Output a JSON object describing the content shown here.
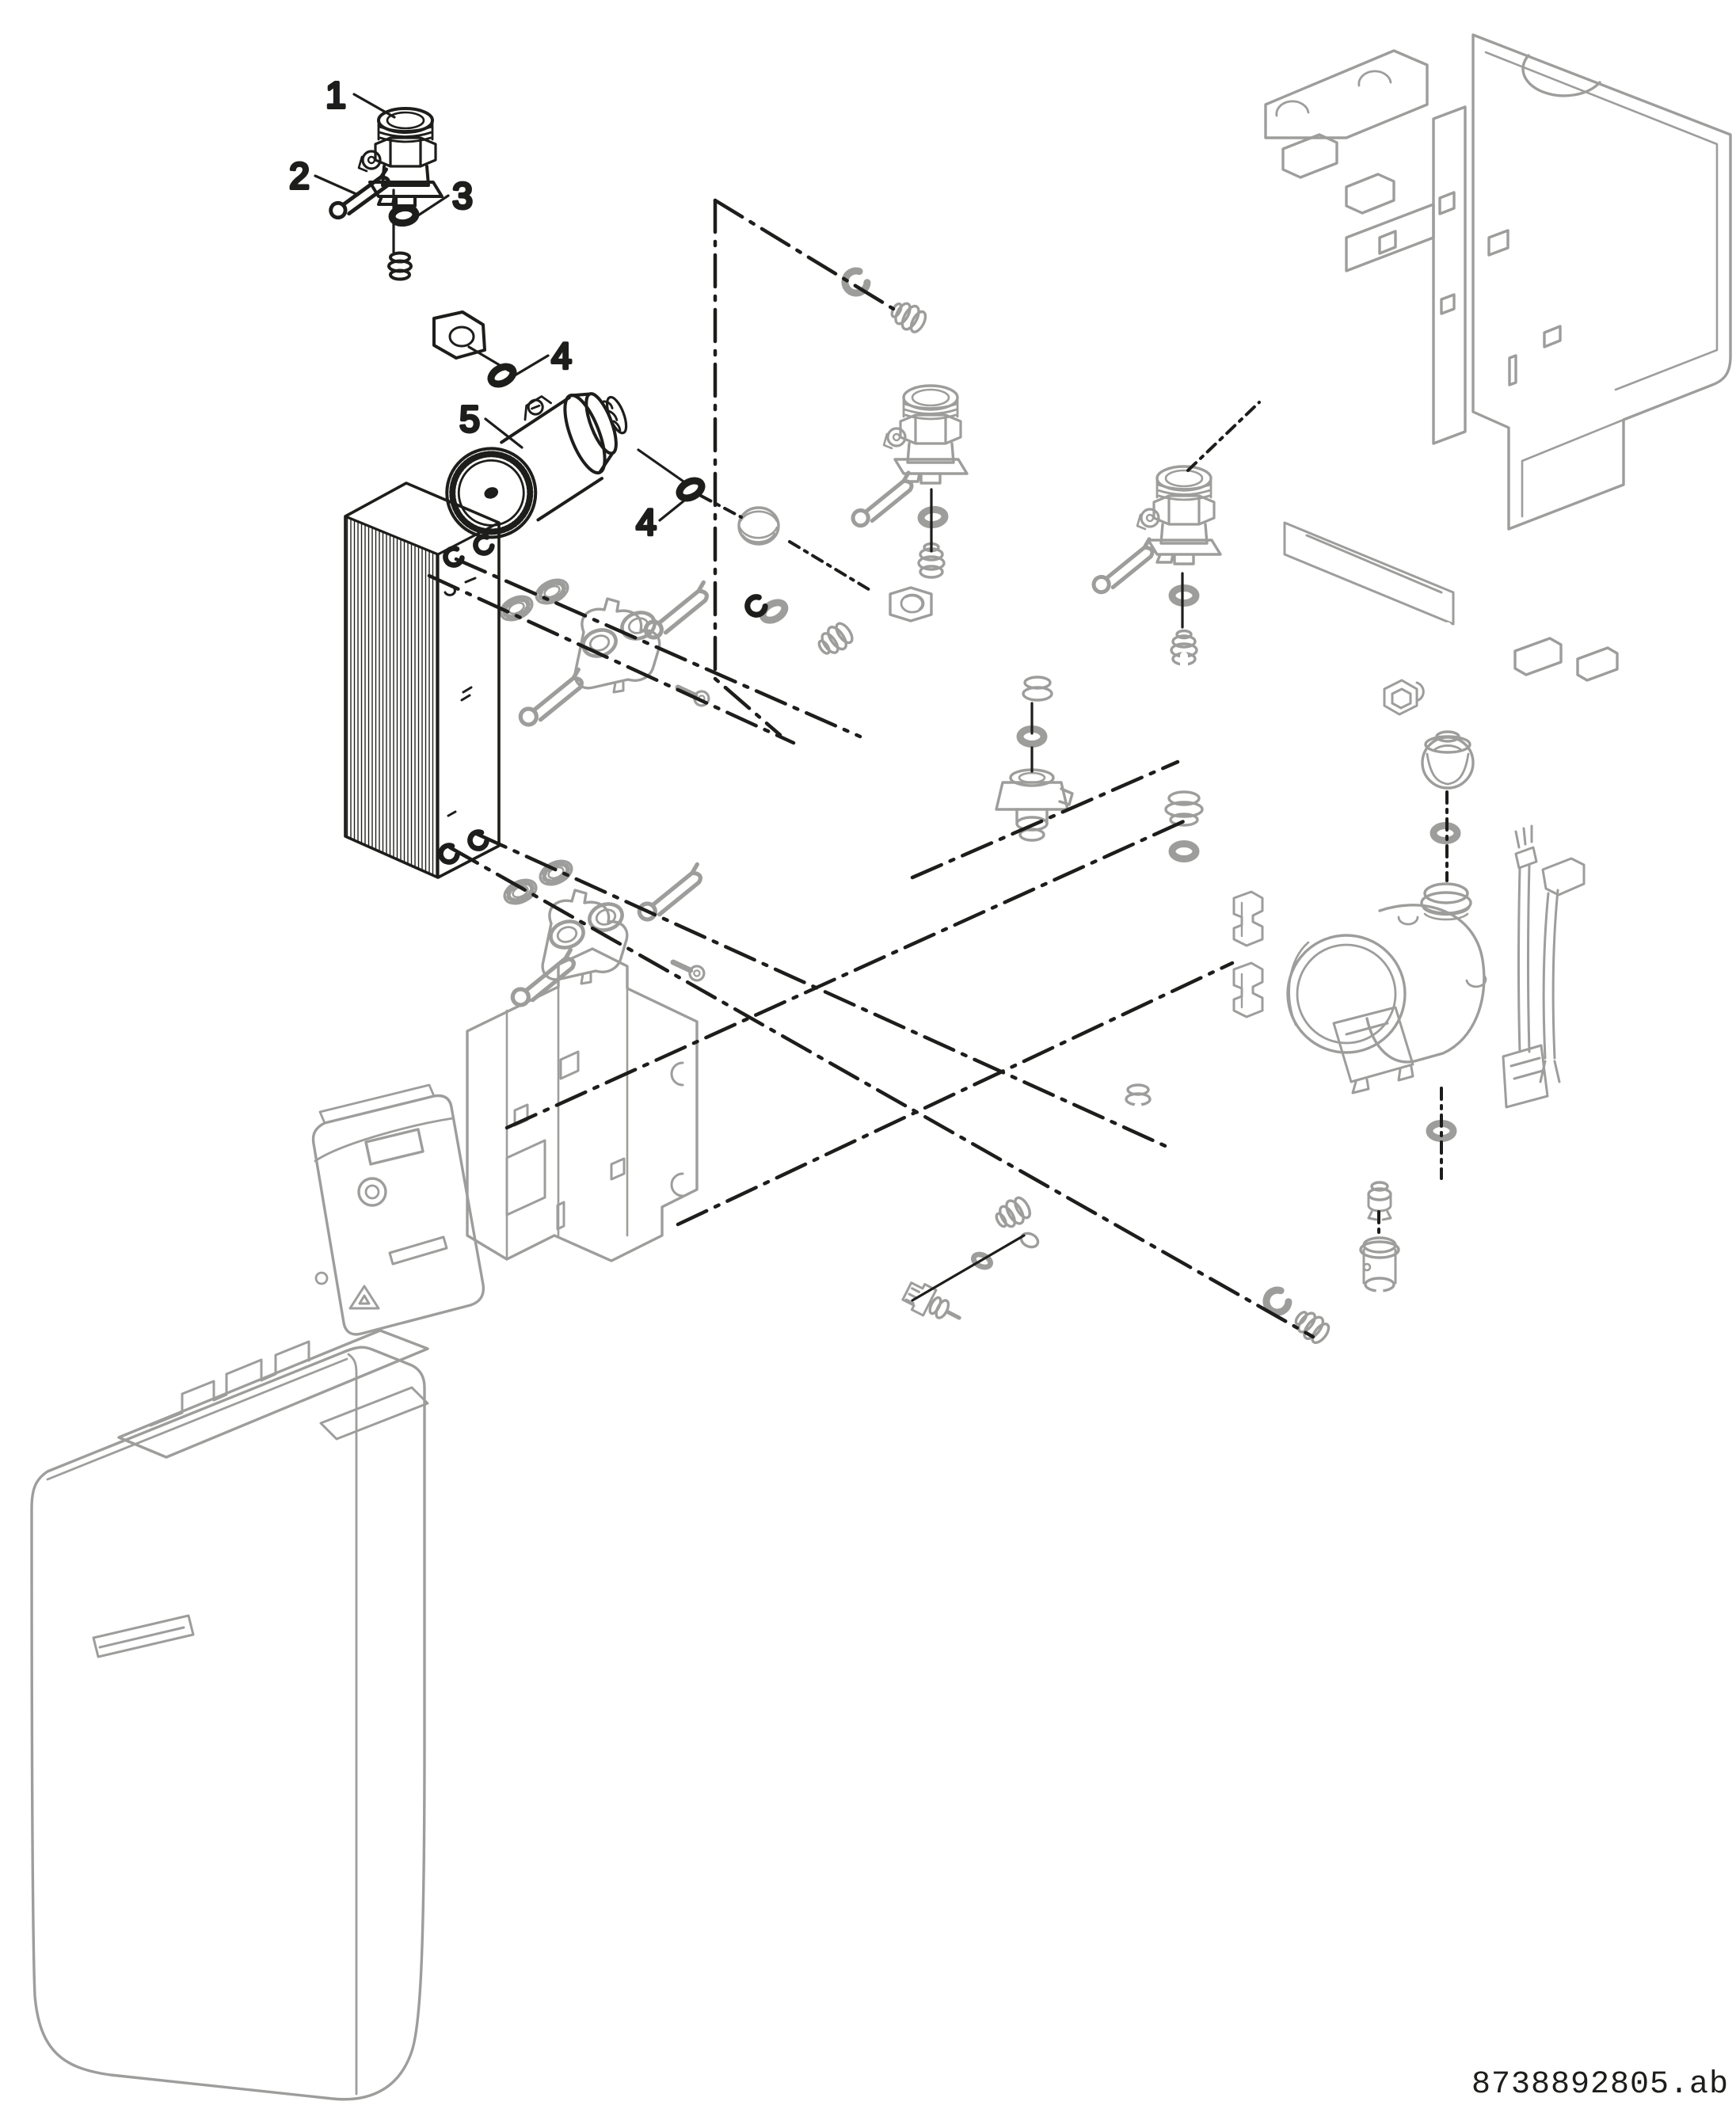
{
  "page": {
    "background": "#ffffff"
  },
  "colors": {
    "highlighted_part": "#1d1d1b",
    "context_part": "#9d9d9c",
    "centerline": "#1d1d1b",
    "label_text": "#2b2b2b"
  },
  "callouts": [
    {
      "label": "1",
      "part": "service-valve-fitting"
    },
    {
      "label": "2",
      "part": "retaining-clip"
    },
    {
      "label": "3",
      "part": "sealing-washer"
    },
    {
      "label": "4",
      "part": "o-ring-seal-upper"
    },
    {
      "label": "4",
      "part": "o-ring-seal-lower"
    },
    {
      "label": "5",
      "part": "dhw-pump-cartridge"
    }
  ],
  "footer": {
    "doc_number": "8738892805.ab"
  }
}
